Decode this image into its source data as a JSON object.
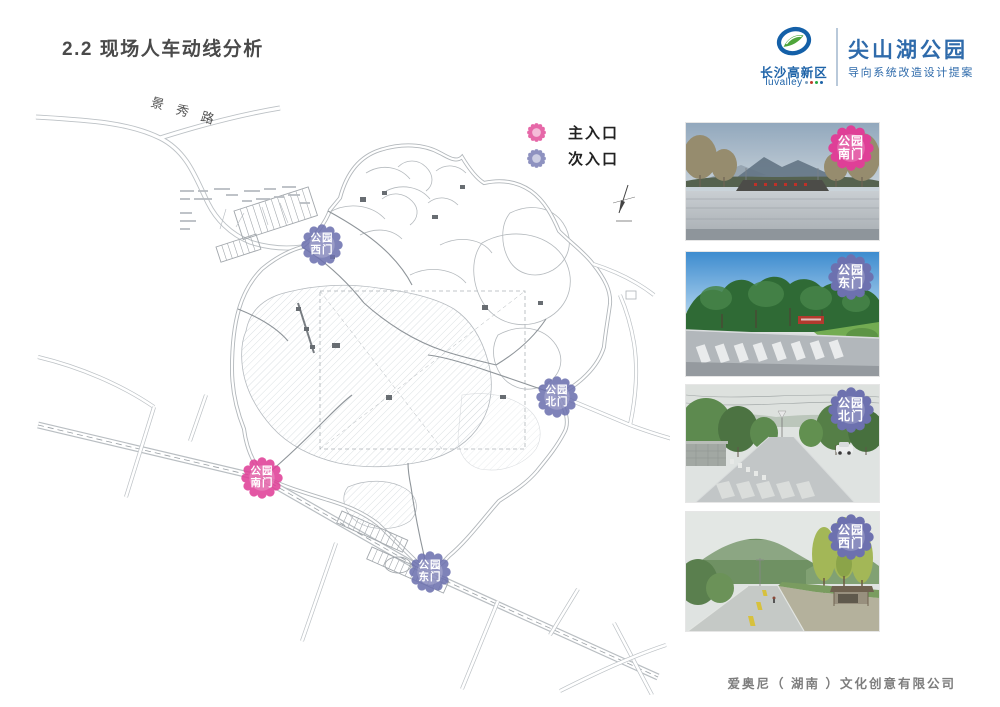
{
  "page": {
    "title": "2.2 现场人车动线分析",
    "footer": "爱奥尼（ 湖南 ）文化创意有限公司"
  },
  "header": {
    "logo": {
      "org_cn": "长沙高新区",
      "org_en": "luvalley"
    },
    "project": {
      "title": "尖山湖公园",
      "subtitle": "导向系统改造设计提案"
    }
  },
  "legend": {
    "items": [
      {
        "label": "主入口",
        "type": "main"
      },
      {
        "label": "次入口",
        "type": "secondary"
      }
    ]
  },
  "map": {
    "road_label": "景秀路",
    "markers": [
      {
        "line1": "公园",
        "line2": "西门",
        "type": "secondary"
      },
      {
        "line1": "公园",
        "line2": "北门",
        "type": "secondary"
      },
      {
        "line1": "公园",
        "line2": "南门",
        "type": "main"
      },
      {
        "line1": "公园",
        "line2": "东门",
        "type": "secondary"
      }
    ]
  },
  "photos": [
    {
      "badge": {
        "line1": "公园",
        "line2": "南门",
        "type": "main"
      }
    },
    {
      "badge": {
        "line1": "公园",
        "line2": "东门",
        "type": "secondary"
      }
    },
    {
      "badge": {
        "line1": "公园",
        "line2": "北门",
        "type": "secondary"
      }
    },
    {
      "badge": {
        "line1": "公园",
        "line2": "西门",
        "type": "secondary"
      }
    }
  ],
  "colors": {
    "brand_blue": "#2f6bab",
    "brand_green": "#4ea53b",
    "main_entry_pink": "#df3f97",
    "secondary_entry_purple": "#6d71af"
  }
}
